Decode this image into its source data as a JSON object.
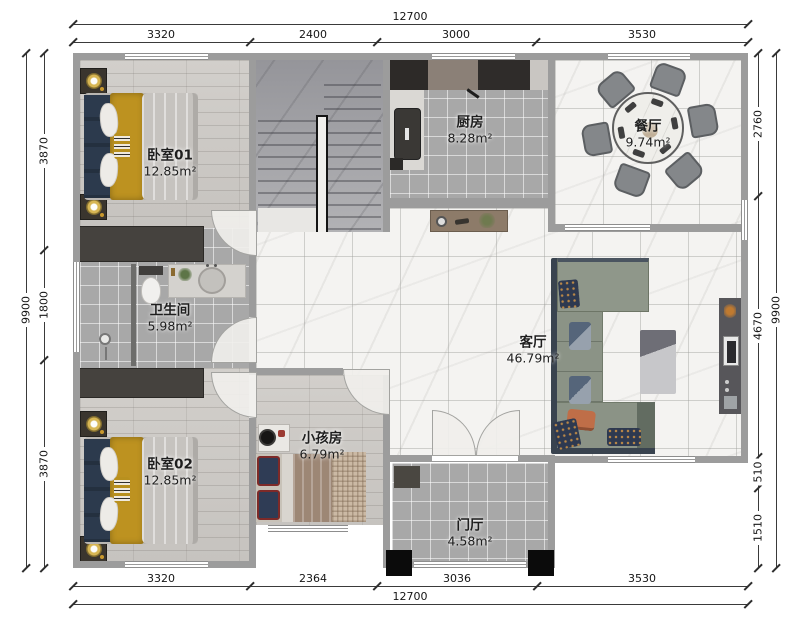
{
  "rooms": {
    "bedroom01": {
      "name": "卧室01",
      "area": "12.85m²"
    },
    "bedroom02": {
      "name": "卧室02",
      "area": "12.85m²"
    },
    "bathroom": {
      "name": "卫生间",
      "area": "5.98m²"
    },
    "kitchen": {
      "name": "厨房",
      "area": "8.28m²"
    },
    "dining": {
      "name": "餐厅",
      "area": "9.74m²"
    },
    "living": {
      "name": "客厅",
      "area": "46.79m²"
    },
    "kids": {
      "name": "小孩房",
      "area": "6.79m²"
    },
    "entry": {
      "name": "门厅",
      "area": "4.58m²"
    }
  },
  "dims": {
    "top": {
      "total": "12700",
      "segments": [
        "3320",
        "2400",
        "3000",
        "3530"
      ]
    },
    "bottom": {
      "total": "12700",
      "segments": [
        "3320",
        "2364",
        "3036",
        "3530"
      ]
    },
    "left": {
      "total": "9900",
      "segments": [
        "3870",
        "1800",
        "3870"
      ]
    },
    "right": {
      "total": "9900",
      "segments": [
        "2760",
        "4670",
        "510",
        "1510"
      ]
    }
  },
  "colors": {
    "wall": "#9c9c9c",
    "wood_floor": "#ccc9c5",
    "tile_floor": "#a8a8a8",
    "marble_floor": "#f4f3f1",
    "closet_dark": "#45423e",
    "sofa_green": "#8b9386",
    "bed_navy": "#2c3a4d",
    "bed_mustard": "#bd9220",
    "accent_orange": "#bf6e48"
  }
}
